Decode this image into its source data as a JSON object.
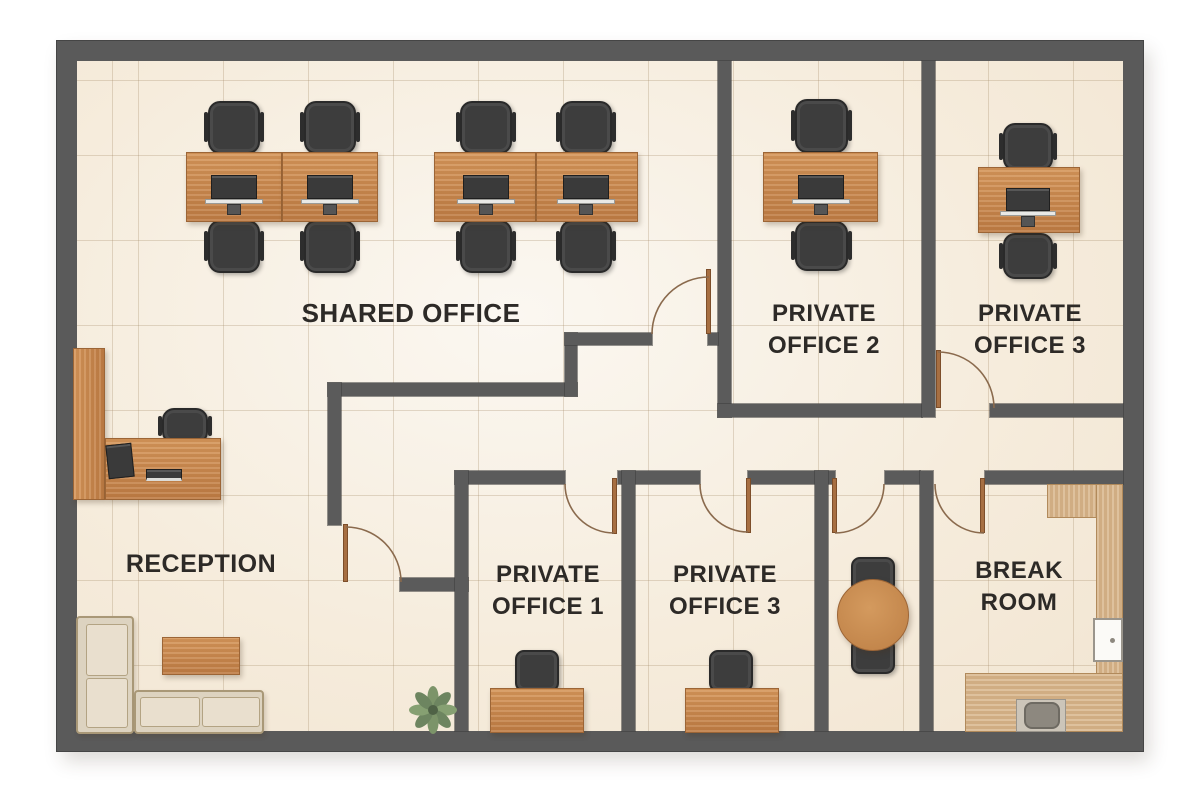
{
  "rooms": {
    "shared_office": {
      "label": "SHARED OFFICE",
      "furniture": [
        "4 desks",
        "8 office chairs",
        "4 monitors"
      ]
    },
    "private_office_2": {
      "line1": "PRIVATE",
      "line2": "OFFICE 2",
      "furniture": [
        "1 desk",
        "2 office chairs",
        "1 monitor"
      ]
    },
    "private_office_3_top": {
      "line1": "PRIVATE",
      "line2": "OFFICE 3",
      "furniture": [
        "1 desk",
        "2 office chairs",
        "1 monitor"
      ]
    },
    "reception": {
      "label": "RECEPTION",
      "furniture": [
        "L-shaped reception desk",
        "office chair",
        "monitor",
        "keyboard tray",
        "L-shaped sofa",
        "coffee table",
        "potted plant"
      ]
    },
    "private_office_1": {
      "line1": "PRIVATE",
      "line2": "OFFICE 1",
      "furniture": [
        "1 desk",
        "1 office chair"
      ]
    },
    "private_office_3_bottom": {
      "line1": "PRIVATE",
      "line2": "OFFICE 3",
      "furniture": [
        "1 desk",
        "1 office chair"
      ]
    },
    "meeting_nook": {
      "furniture": [
        "round table",
        "2 chairs"
      ]
    },
    "break_room": {
      "line1": "BREAK",
      "line2": "ROOM",
      "furniture": [
        "kitchen counters",
        "sink",
        "fridge"
      ]
    }
  },
  "palette": {
    "wall": "#5b5b5b",
    "floor": "#f6eee0",
    "tile_line": "#d9c9b2",
    "wood_desk": "#cb8a50",
    "wood_counter": "#d8b68c",
    "chair": "#3d3d3d",
    "sofa": "#ddd3c0",
    "door_leaf": "#a76f42",
    "door_arc": "#8a6a4d",
    "label_text": "#2d2a27",
    "sink_basin": "#8d887f",
    "fridge": "#fbfaf7",
    "plant": "#7c9469"
  }
}
